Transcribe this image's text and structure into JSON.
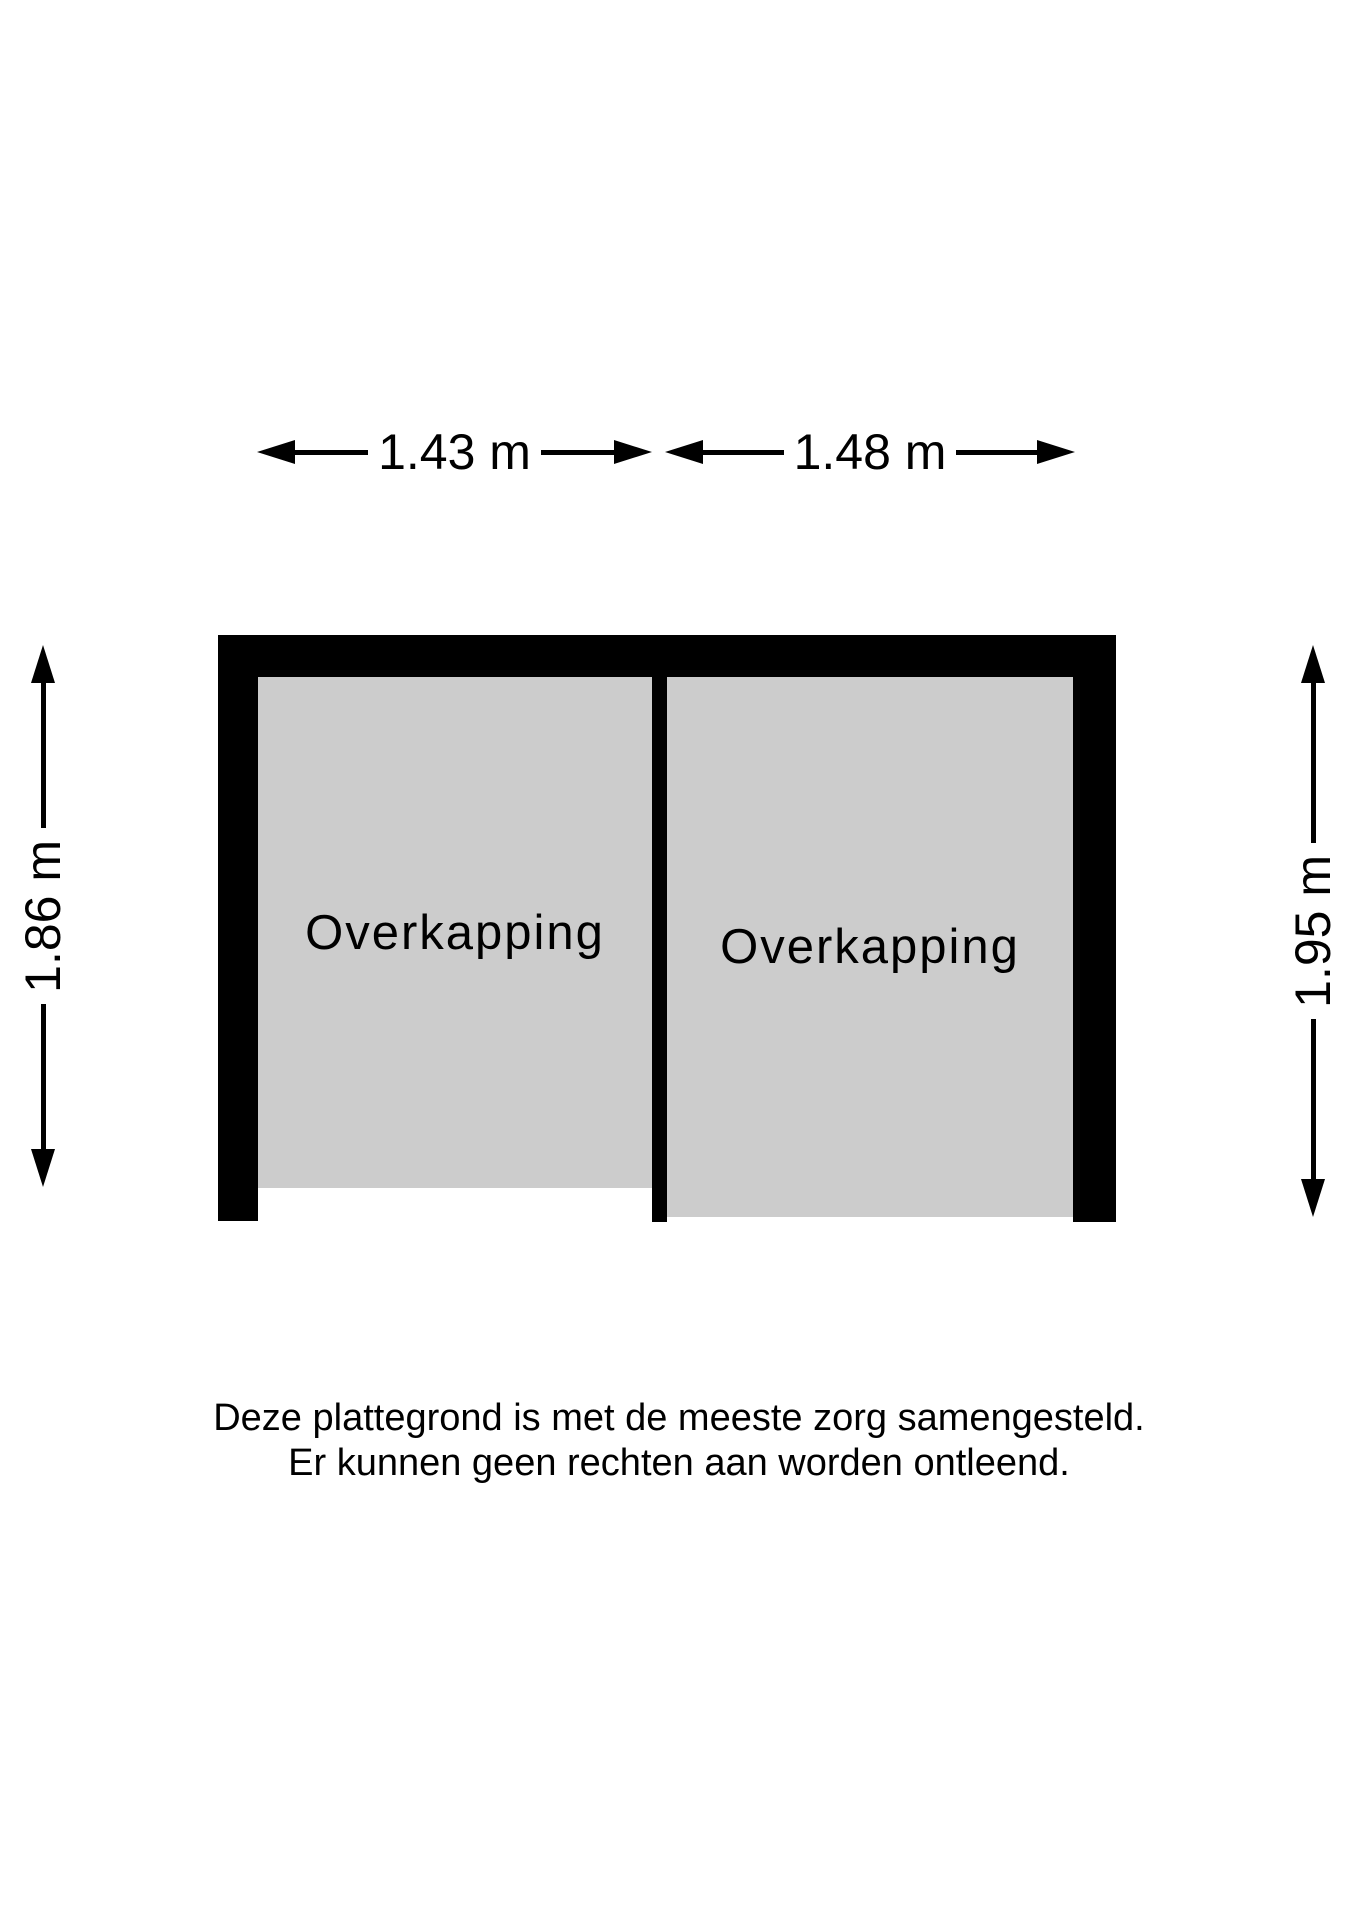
{
  "dimensions": {
    "top": [
      {
        "label": "1.43 m"
      },
      {
        "label": "1.48 m"
      }
    ],
    "left": {
      "label": "1.86 m"
    },
    "right": {
      "label": "1.95 m"
    }
  },
  "rooms": [
    {
      "label": "Overkapping"
    },
    {
      "label": "Overkapping"
    }
  ],
  "disclaimer": {
    "line1": "Deze plattegrond is met de meeste zorg samengesteld.",
    "line2": "Er kunnen geen rechten aan worden ontleend."
  },
  "colors": {
    "wall": "#000000",
    "room_fill": "#cccccc",
    "text": "#000000",
    "background": "#ffffff"
  }
}
